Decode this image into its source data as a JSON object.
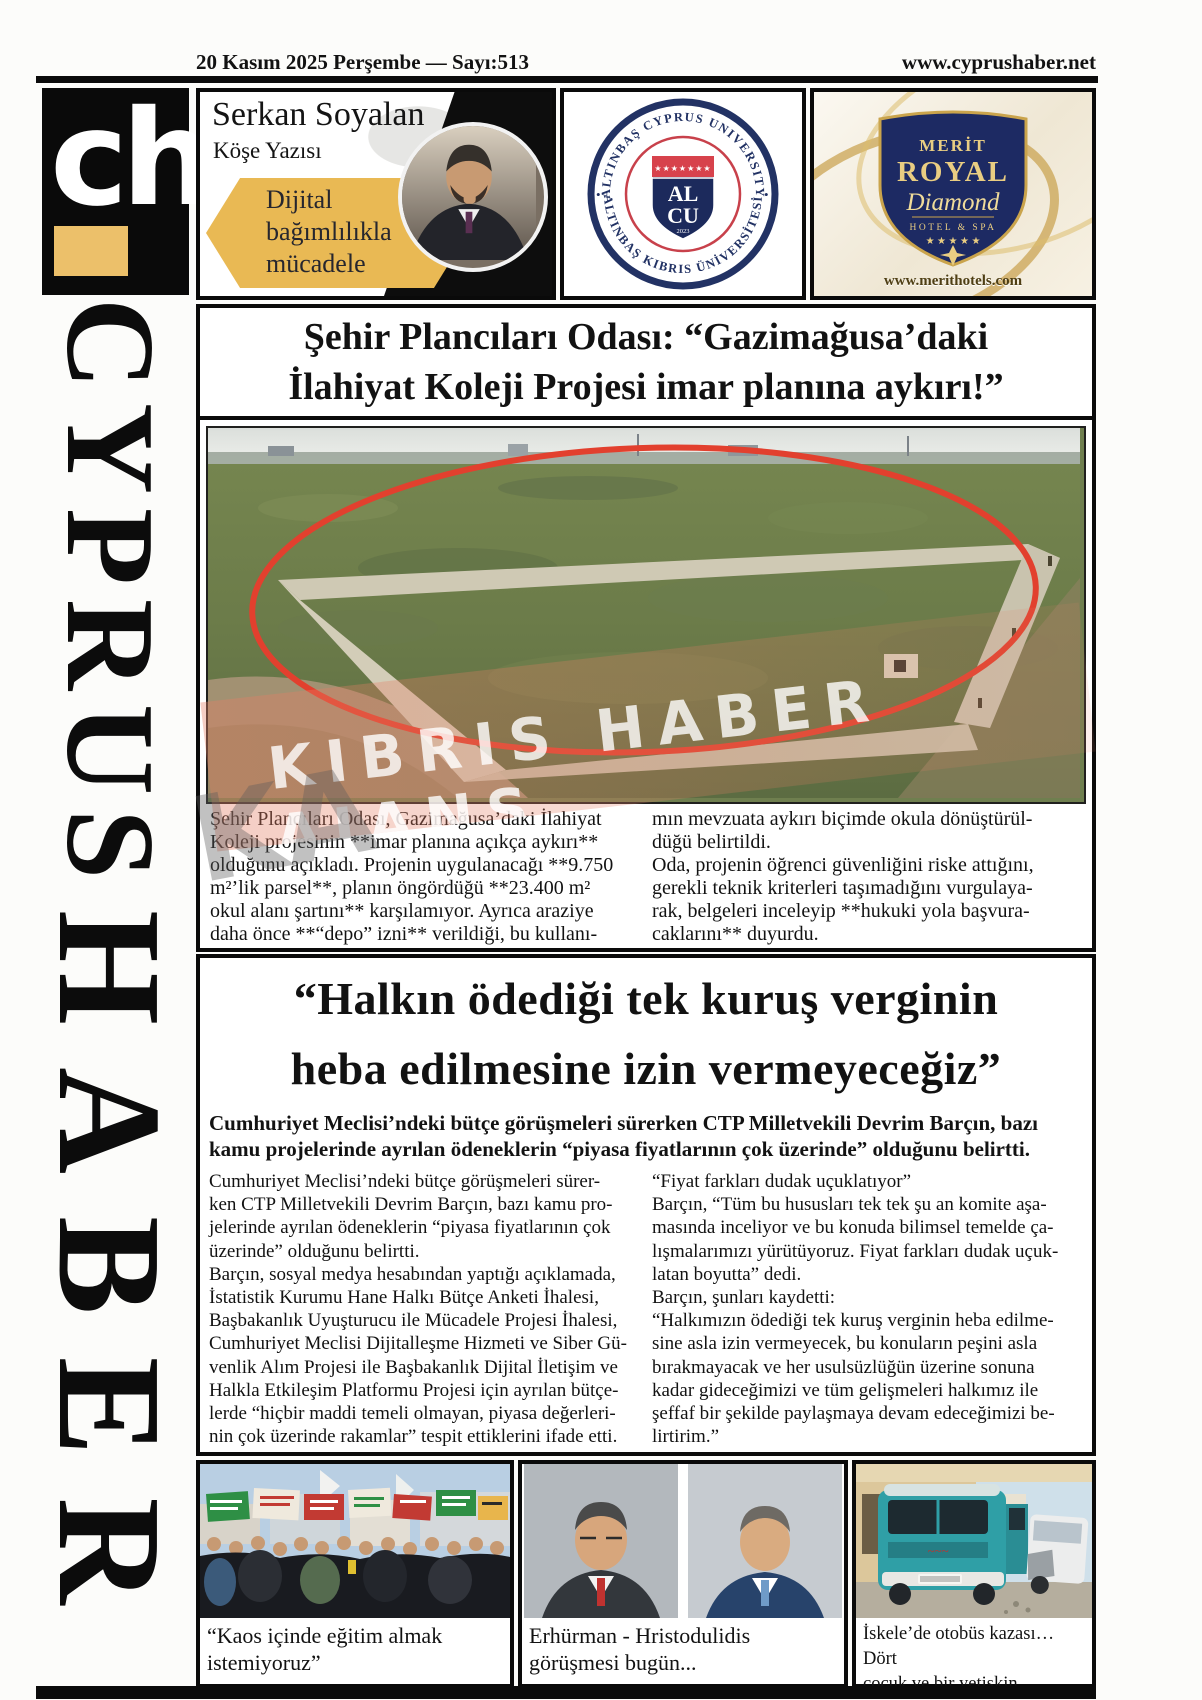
{
  "page": {
    "date_line": "20 Kasım 2025 Perşembe —  Sayı:513",
    "website": "www.cyprushaber.net"
  },
  "masthead": {
    "logo": "ch",
    "title_top": "CYPRUS",
    "title_bottom": "HABER"
  },
  "columnist": {
    "name": "Serkan Soyalan",
    "subtitle": "Köşe Yazısı",
    "topic": "Dijital\nbağımlılıkla\nmücadele"
  },
  "university_ad": {
    "ring_top": "ALTINBAŞ CYPRUS UNIVERSITY",
    "ring_bottom": "ALTINBAŞ KIBRIS ÜNİVERSİTESİ",
    "separator": "•",
    "stars": "★★★★★★★",
    "shield_top": "AL",
    "shield_bottom": "CU",
    "year": "2023"
  },
  "hotel_ad": {
    "name_line1": "MERİT",
    "name_line2": "ROYAL",
    "name_line3": "Diamond",
    "name_line4": "HOTEL & SPA",
    "stars": "★ ★ ★ ★ ★",
    "website": "www.merithotels.com"
  },
  "story1": {
    "headline": "Şehir Plancıları Odası: “Gazimağusa’daki\nİlahiyat Koleji Projesi imar planına aykırı!”",
    "col_left": "Şehir Plancıları Odası, Gazimağusa’daki İlahiyat\nKoleji projesinin **imar planına açıkça aykırı**\nolduğunu açıkladı. Projenin uygulanacağı **9.750\nm²’lik parsel**, planın öngördüğü **23.400 m²\nokul alanı şartını** karşılamıyor. Ayrıca araziye\ndaha önce **“depo” izni** verildiği, bu kullanı-",
    "col_right": "mın mevzuata aykırı biçimde okula dönüştürül-\ndüğü belirtildi.\nOda, projenin öğrenci güvenliğini riske attığını,\ngerekli teknik kriterleri taşımadığını vurgulaya-\nrak, belgeleri inceleyip **hukuki yola başvura-\ncaklarını** duyurdu."
  },
  "watermark": {
    "initials": "KA",
    "text": "KIBRIS HABER AJANS"
  },
  "story2": {
    "headline": "“Halkın ödediği tek kuruş verginin\nheba edilmesine izin vermeyeceğiz”",
    "standfirst": "Cumhuriyet Meclisi’ndeki bütçe görüşmeleri sürerken CTP Milletvekili Devrim Barçın, bazı\nkamu projelerinde ayrılan ödeneklerin “piyasa fiyatlarının çok üzerinde” olduğunu belirtti.",
    "col_left": "Cumhuriyet Meclisi’ndeki bütçe görüşmeleri sürer-\nken CTP Milletvekili Devrim Barçın, bazı kamu pro-\njelerinde ayrılan ödeneklerin “piyasa fiyatlarının çok\nüzerinde” olduğunu belirtti.\nBarçın, sosyal medya hesabından yaptığı açıklamada,\nİstatistik Kurumu Hane Halkı Bütçe Anketi İhalesi,\nBaşbakanlık Uyuşturucu ile Mücadele Projesi İhalesi,\nCumhuriyet Meclisi Dijitalleşme Hizmeti ve Siber Gü-\nvenlik Alım Projesi ile Başbakanlık Dijital İletişim ve\nHalkla Etkileşim Platformu Projesi için ayrılan bütçe-\nlerde “hiçbir maddi temeli olmayan, piyasa değerleri-\nnin çok üzerinde rakamlar” tespit ettiklerini ifade etti.",
    "col_right": "“Fiyat farkları dudak uçuklatıyor”\nBarçın, “Tüm bu hususları tek tek şu an komite aşa-\nmasında inceliyor ve bu konuda bilimsel temelde ça-\nlışmalarımızı yürütüyoruz. Fiyat farkları dudak uçuk-\nlatan boyutta” dedi.\n Barçın, şunları kaydetti:\n“Halkımızın ödediği tek kuruş verginin heba edilme-\nsine asla izin vermeyecek, bu konuların peşini asla\nbırakmayacak ve her usulsüzlüğün üzerine sonuna\nkadar gideceğimizi ve tüm gelişmeleri halkımız ile\nşeffaf bir şekilde paylaşmaya devam edeceğimizi be-\nlirtirim.”"
  },
  "bottom_stories": [
    {
      "caption": "“Kaos içinde eğitim almak\nistemiyoruz”"
    },
    {
      "caption": "Erhürman - Hristodulidis\ngörüşmesi bugün..."
    },
    {
      "caption": "İskele’de otobüs kazası…Dört\nçocuk ve bir yetişkin yaralandı"
    }
  ],
  "colors": {
    "accent_gold": "#e9b954",
    "navy": "#1c2a5c",
    "seal_red": "#d7424c",
    "circle_red": "#e2402e"
  }
}
